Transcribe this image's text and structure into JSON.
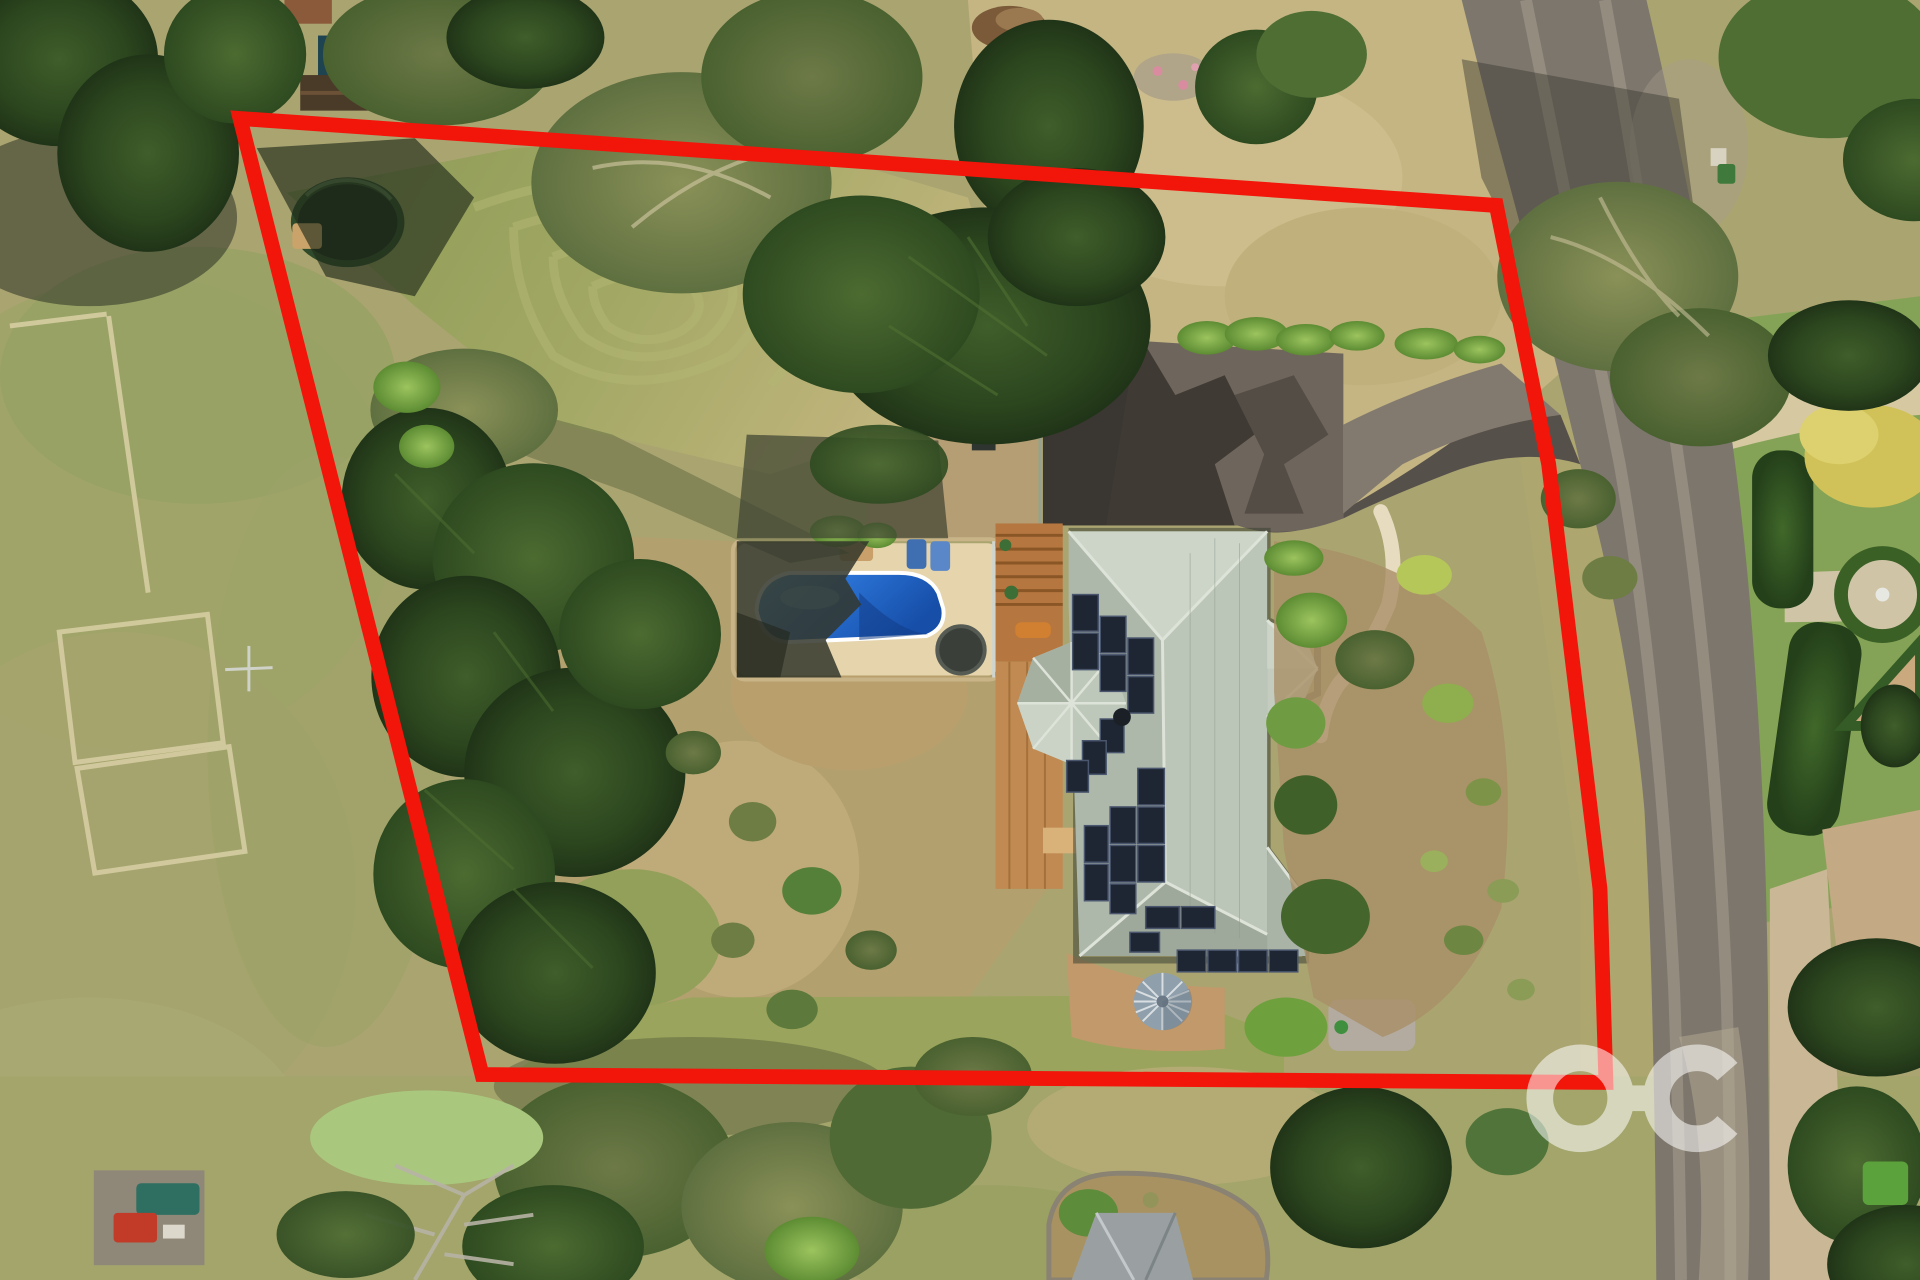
{
  "meta": {
    "type": "aerial-drone-photograph",
    "description": "Top-down aerial photo of a rural residential acreage with a red property-boundary outline, house with solar panels, swimming pool, gardens, paddock and road",
    "width_px": "1920",
    "height_px": "1280"
  },
  "watermark": {
    "text": "OC",
    "color": "#ffffff",
    "opacity": "0.55"
  },
  "boundary": {
    "color": "#f2150a",
    "stroke_width": "15",
    "label": "Red property boundary outline"
  },
  "palette": {
    "paddock": "#aaa471",
    "lawn": "#9aa45c",
    "road": "#7d766d",
    "driveway": "#56504a",
    "roof": "#bcc6b8",
    "roof_shade": "#9fa99b",
    "solar": "#1f2633",
    "pool_water": "#2a72d4",
    "pool_paving": "#e6d5ac",
    "deck": "#b5763f",
    "tank": "#8fa0ac",
    "hedge": "#35571f",
    "shoulder_gravel": "#c9b795"
  },
  "scene": {
    "photo": "Aerial view of property",
    "boundary": "Property boundary",
    "road": "Sealed road along eastern side",
    "driveway": "Asphalt driveway",
    "house": "House with sage metal roof and solar panels",
    "solar": "Rooftop solar panel arrays",
    "pool": "In-ground swimming pool",
    "pool_area": "Pool paving and surrounds",
    "deck": "Timber deck and pergola",
    "tank": "Round water tank",
    "trampoline": "Trampoline",
    "lawn": "Mown lawn with striping",
    "paddock": "Neighbouring dry paddock",
    "formal_garden": "Neighbour's formal hedge garden",
    "trees": "Mixed conifer and eucalyptus trees",
    "watermark": "Agency watermark"
  }
}
